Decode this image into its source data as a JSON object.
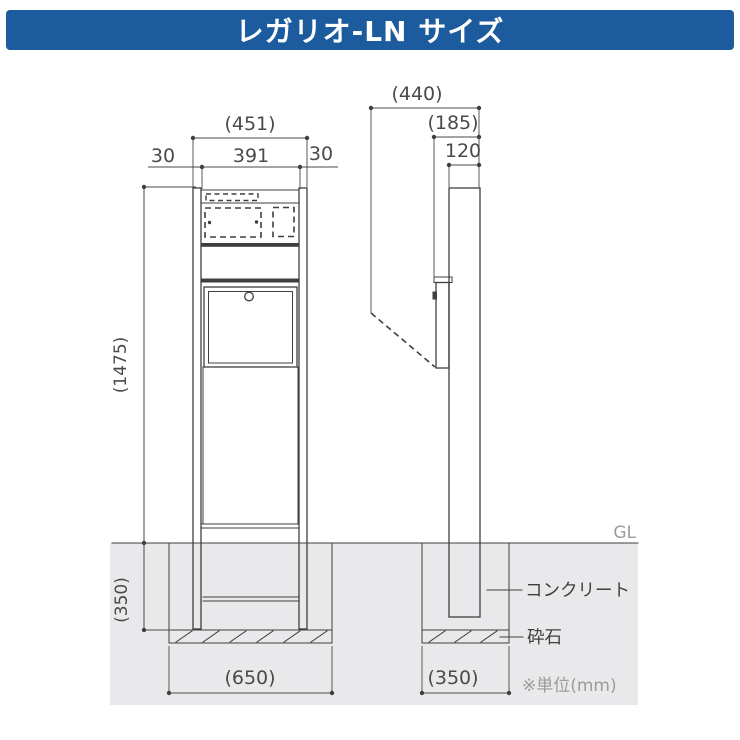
{
  "header": {
    "title": "レガリオ-LN サイズ"
  },
  "front_view": {
    "dim_overall_width": "(451)",
    "dim_margin_left": "30",
    "dim_width_inner": "391",
    "dim_margin_right": "30",
    "dim_height_above_ground": "(1475)",
    "dim_embed_depth": "(350)",
    "dim_foundation_width": "(650)"
  },
  "side_view": {
    "dim_depth_door_open": "(440)",
    "dim_depth_with_box": "(185)",
    "dim_post_depth": "120",
    "dim_foundation_width": "(350)"
  },
  "annotations": {
    "ground_level": "GL",
    "concrete": "コンクリート",
    "crushed_stone": "砕石",
    "unit_note": "※単位(mm)"
  },
  "colors": {
    "header_bg": "#1b5b9e",
    "header_text": "#ffffff",
    "line": "#3f3f3f",
    "dim_text": "#4a4a4a",
    "muted_text": "#9b9b9b",
    "underground_fill": "#e9e9eb"
  }
}
